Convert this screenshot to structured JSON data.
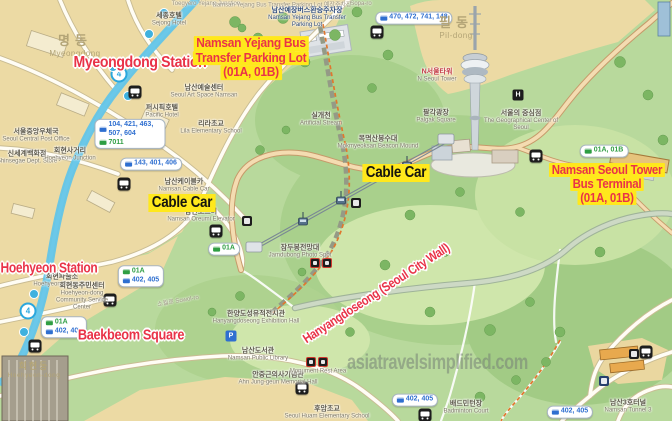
{
  "watermark": "asiatravelsimplified.com",
  "labels": {
    "myeongdong_station": "Myeongdong Station",
    "hoehyeon_station": "Hoehyeon Station",
    "baekbeom_square": "Baekbeom Square",
    "cable_car_west": "Cable Car",
    "cable_car_summit": "Cable Car",
    "hanyangdoseong": "Hanyangdoseong (Seoul City Wall)",
    "yejang_parking": {
      "l1": "Namsan Yejang Bus",
      "l2": "Transfer Parking Lot",
      "l3": "(01A, 01B)"
    },
    "tower_terminal": {
      "l1": "Namsan Seoul Tower",
      "l2": "Bus Terminal",
      "l3": "(01A, 01B)"
    }
  },
  "districts": {
    "myeongdong": {
      "ko": "명동",
      "en": "Myeongdong"
    },
    "pildong": {
      "ko": "필동",
      "en": "Pil-dong"
    },
    "hoehyeondong": {
      "ko": "회현동",
      "en": "Hoehyeon-dong"
    }
  },
  "places": {
    "post_office": {
      "ko": "서울중앙우체국",
      "en": "Seoul Central Post Office"
    },
    "shinsegae": {
      "ko": "신세계백화점",
      "en": "Shinsegae Dept. Store"
    },
    "hoehyeon_junction": {
      "ko": "회현사거리",
      "en": "Hoehyeon Junction"
    },
    "sejong_hotel": {
      "ko": "세종호텔",
      "en": "Sejong Hotel"
    },
    "pacific_hotel": {
      "ko": "퍼시픽호텔",
      "en": "Pacific Hotel"
    },
    "art_space": {
      "ko": "남산예술센터",
      "en": "Seoul Art Space Namsan"
    },
    "lila_school": {
      "ko": "리라초교",
      "en": "Lila Elementary School"
    },
    "yejang_lot": {
      "ko": "남산예장버스환승주차장",
      "en": "Namsan Yejang Bus Transfer Parking Lot"
    },
    "artificial_stream": {
      "ko": "실개천",
      "en": "Artificial Stream"
    },
    "cable_car_station": {
      "ko": "남산케이블카",
      "en": "Namsan Cable Car"
    },
    "oreumi": {
      "ko": "남산오르미",
      "en": "Namsan Oreumi Elevator"
    },
    "police_box": {
      "ko": "회현파출소",
      "en": "Hoehyeon Police Box"
    },
    "community_center": {
      "ko": "회현동주민센터",
      "en": "Hoehyeon-dong Community Service Center"
    },
    "n_seoul_tower": {
      "ko": "N서울타워",
      "en": "N Seoul Tower"
    },
    "palgak": {
      "ko": "팔각광장",
      "en": "Palgak Square"
    },
    "geo_center": {
      "ko": "서울의 중심점",
      "en": "The Geographical Center of Seoul"
    },
    "beacon": {
      "ko": "목멱산봉수대",
      "en": "Mokmyeoksan Beacon Mound"
    },
    "jamdubong": {
      "ko": "잠두봉전망대",
      "en": "Jamdubong Photo Spot"
    },
    "wall_hall": {
      "ko": "한양도성유적전시관",
      "en": "Hanyangdoseong Exhibition Hall"
    },
    "library": {
      "ko": "남산도서관",
      "en": "Namsan Public Library"
    },
    "ahn_memorial": {
      "ko": "안중근의사기념관",
      "en": "Ahn Jung-geun Memorial Hall"
    },
    "monument_rest": {
      "en": "Monument Rest Area"
    },
    "huam_school": {
      "ko": "후암초교",
      "en": "Seoul Huam Elementary School"
    },
    "tunnel3": {
      "ko": "남산3호터널",
      "en": "Namsan Tunnel 3"
    },
    "badminton": {
      "ko": "배드민턴장",
      "en": "Badminton Court"
    }
  },
  "streets": {
    "sopa_ro": "Sopa-ro",
    "sowol_ro": "소월로 Sowol-ro",
    "top_junction": "Toegyero Yejang Junction",
    "top_parking": "Namsan Yejang Bus Transfer Parking Lot 예장주차장"
  },
  "bus_stops": {
    "myeongdong_blue": "104, 421, 463, 507, 604",
    "myeongdong_green": "7011",
    "cablecar_blue": "143, 401, 406",
    "top_blue": "470, 472, 741, 148",
    "hoehyeon1_green": "01A",
    "hoehyeon1_blue": "402, 405",
    "hoehyeon2_green": "01A",
    "hoehyeon2_blue": "402, 405",
    "south_blue": "402, 405",
    "southeast_blue": "402, 405",
    "terminal_green": "01A, 01B",
    "oreumi_green": "01A"
  },
  "metro": {
    "line_badge": "4"
  },
  "icons": {
    "helipad": "H",
    "parking": "P"
  },
  "colors": {
    "highlight_yellow": "#ffe81c",
    "label_red": "#e93348",
    "metro_blue": "#63c5e8",
    "bus_blue": "#2f6fd0",
    "bus_green": "#2f9e43"
  }
}
